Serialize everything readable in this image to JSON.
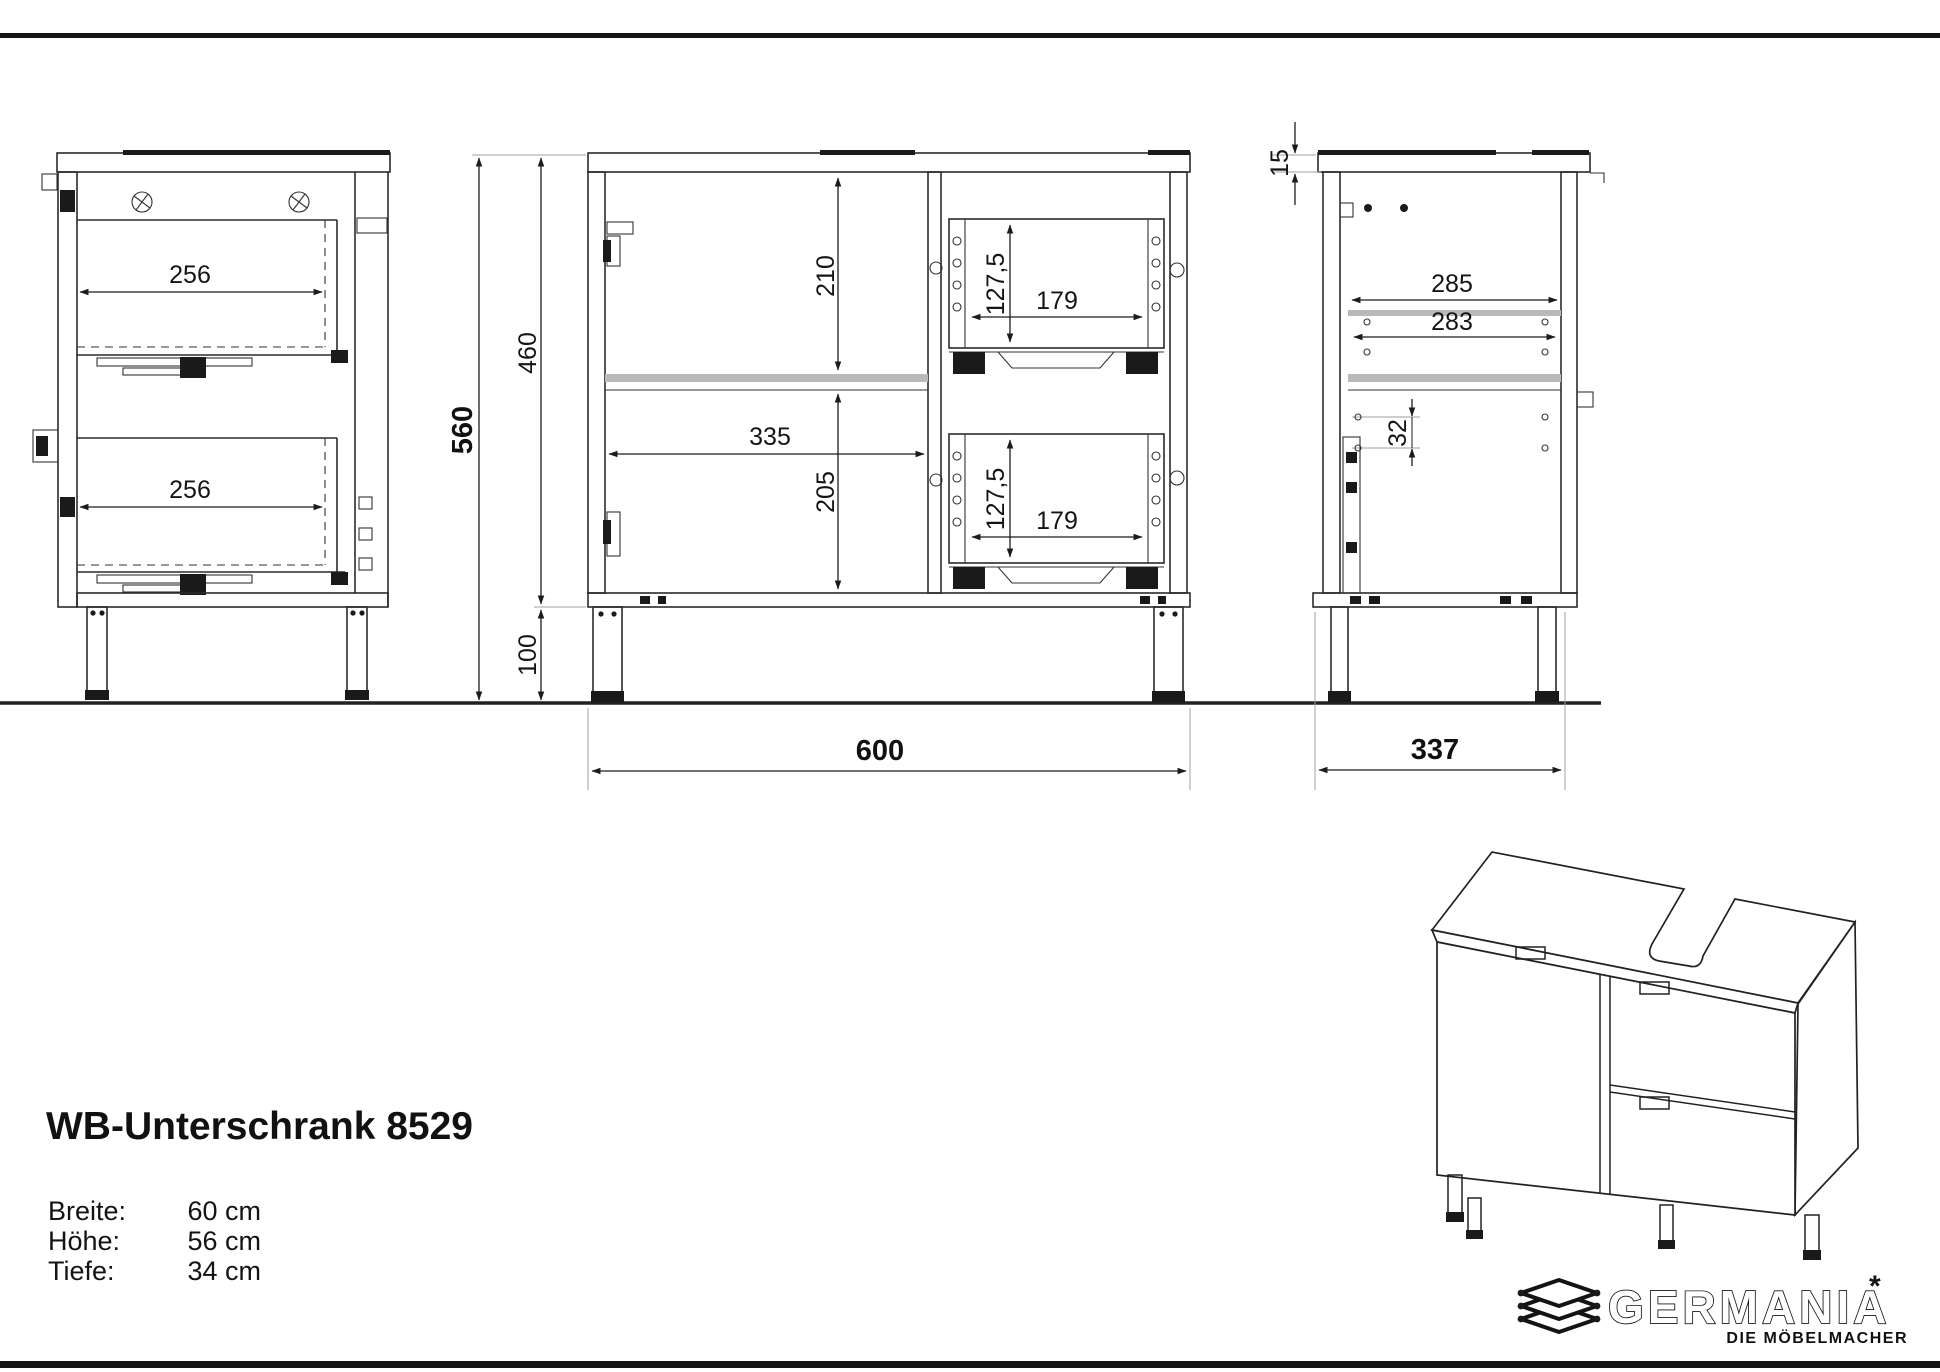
{
  "title_block": {
    "product_title": "WB-Unterschrank 8529",
    "specs": [
      {
        "label": "Breite:",
        "value": "60 cm"
      },
      {
        "label": "Höhe:",
        "value": "56 cm"
      },
      {
        "label": "Tiefe:",
        "value": "34 cm"
      }
    ]
  },
  "views": {
    "side_section": {
      "dim_drawer_depth_top": "256",
      "dim_drawer_depth_bottom": "256"
    },
    "front_section": {
      "dim_total_height": "560",
      "dim_body_height": "460",
      "dim_top_compartment_height": "210",
      "dim_shelf_width": "335",
      "dim_bottom_compartment_height": "205",
      "dim_drawer_inner_height_top": "127,5",
      "dim_drawer_inner_width_top": "179",
      "dim_drawer_inner_height_bottom": "127,5",
      "dim_drawer_inner_width_bottom": "179",
      "dim_leg_height": "100",
      "dim_total_width": "600"
    },
    "rear_side_section": {
      "dim_top_thickness": "15",
      "dim_inner_depth_upper": "285",
      "dim_inner_depth_lower": "283",
      "dim_hole_spacing": "32",
      "dim_total_depth": "337"
    }
  },
  "logo": {
    "brand": "GERMANIA",
    "mark": "*",
    "tagline": "DIE MÖBELMACHER"
  },
  "colors": {
    "line": "#2b2b2b",
    "background": "#ffffff"
  }
}
